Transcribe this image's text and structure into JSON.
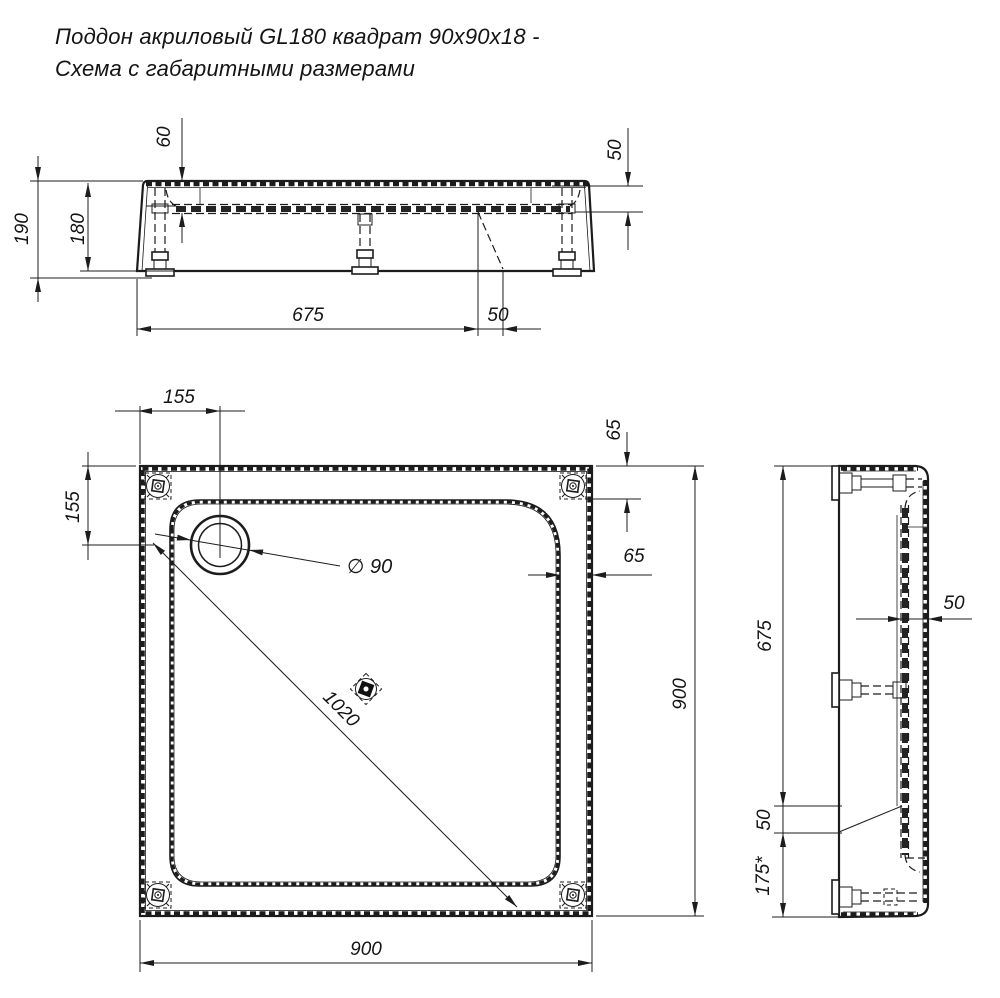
{
  "title": {
    "line1": "Поддон акриловый  GL180 квадрат 90x90x18 -",
    "line2": "Схема с габаритными размерами"
  },
  "views": {
    "elevation": {
      "dims": {
        "d60": "60",
        "d50_depth": "50",
        "d190": "190",
        "d180": "180",
        "d675": "675",
        "d50_drain": "50"
      }
    },
    "plan": {
      "dims": {
        "d155_top": "155",
        "d155_left": "155",
        "d65_top": "65",
        "d65_right": "65",
        "d_drain": "∅ 90",
        "d_diag": "1020",
        "d900_right": "900",
        "d900_bottom": "900"
      }
    },
    "section": {
      "dims": {
        "d675": "675",
        "d50_wall": "50",
        "d50_slope": "50",
        "d175": "175*"
      }
    }
  },
  "colors": {
    "line": "#1c1c1c",
    "background": "#ffffff"
  }
}
